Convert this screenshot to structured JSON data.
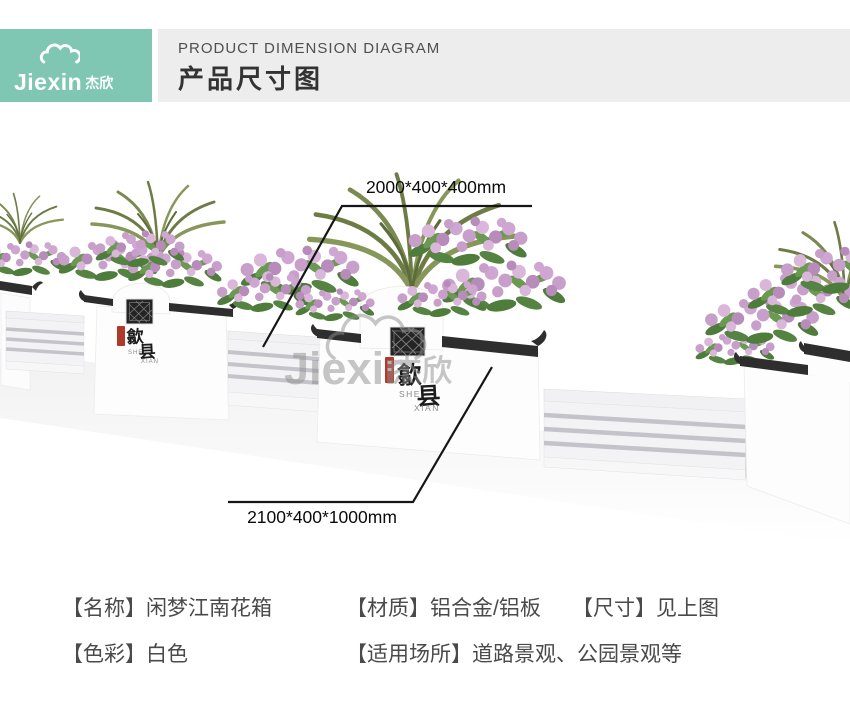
{
  "header": {
    "brand_en": "Jiexin",
    "brand_zh": "杰欣",
    "title_en": "PRODUCT DIMENSION DIAGRAM",
    "title_zh": "产品尺寸图"
  },
  "diagram": {
    "dim_top": "2000*400*400mm",
    "dim_bottom": "2100*400*1000mm",
    "planter_label": {
      "char1": "歙",
      "char2": "县",
      "romaji1": "SHE",
      "romaji2": "XIAN"
    },
    "watermark_en": "Jiexin",
    "watermark_zh": "杰欣"
  },
  "specs": {
    "items": [
      {
        "text": "【名称】闲梦江南花箱"
      },
      {
        "text": "【材质】铝合金/铝板"
      },
      {
        "text": "【尺寸】见上图"
      },
      {
        "text": "【色彩】白色"
      },
      {
        "text": "【适用场所】道路景观、公园景观等"
      }
    ]
  },
  "colors": {
    "brand_teal": "#7fc7b2",
    "header_gray": "#ededed",
    "trim_dark": "#2e2e2e",
    "seal_red": "#b0392c",
    "flower_pink": "#c79fca",
    "leaf_green": "#4e7c3b",
    "palm_olive": "#6d7c45",
    "dimension_line": "#161616",
    "watermark_gray": "#8f8f8f"
  }
}
